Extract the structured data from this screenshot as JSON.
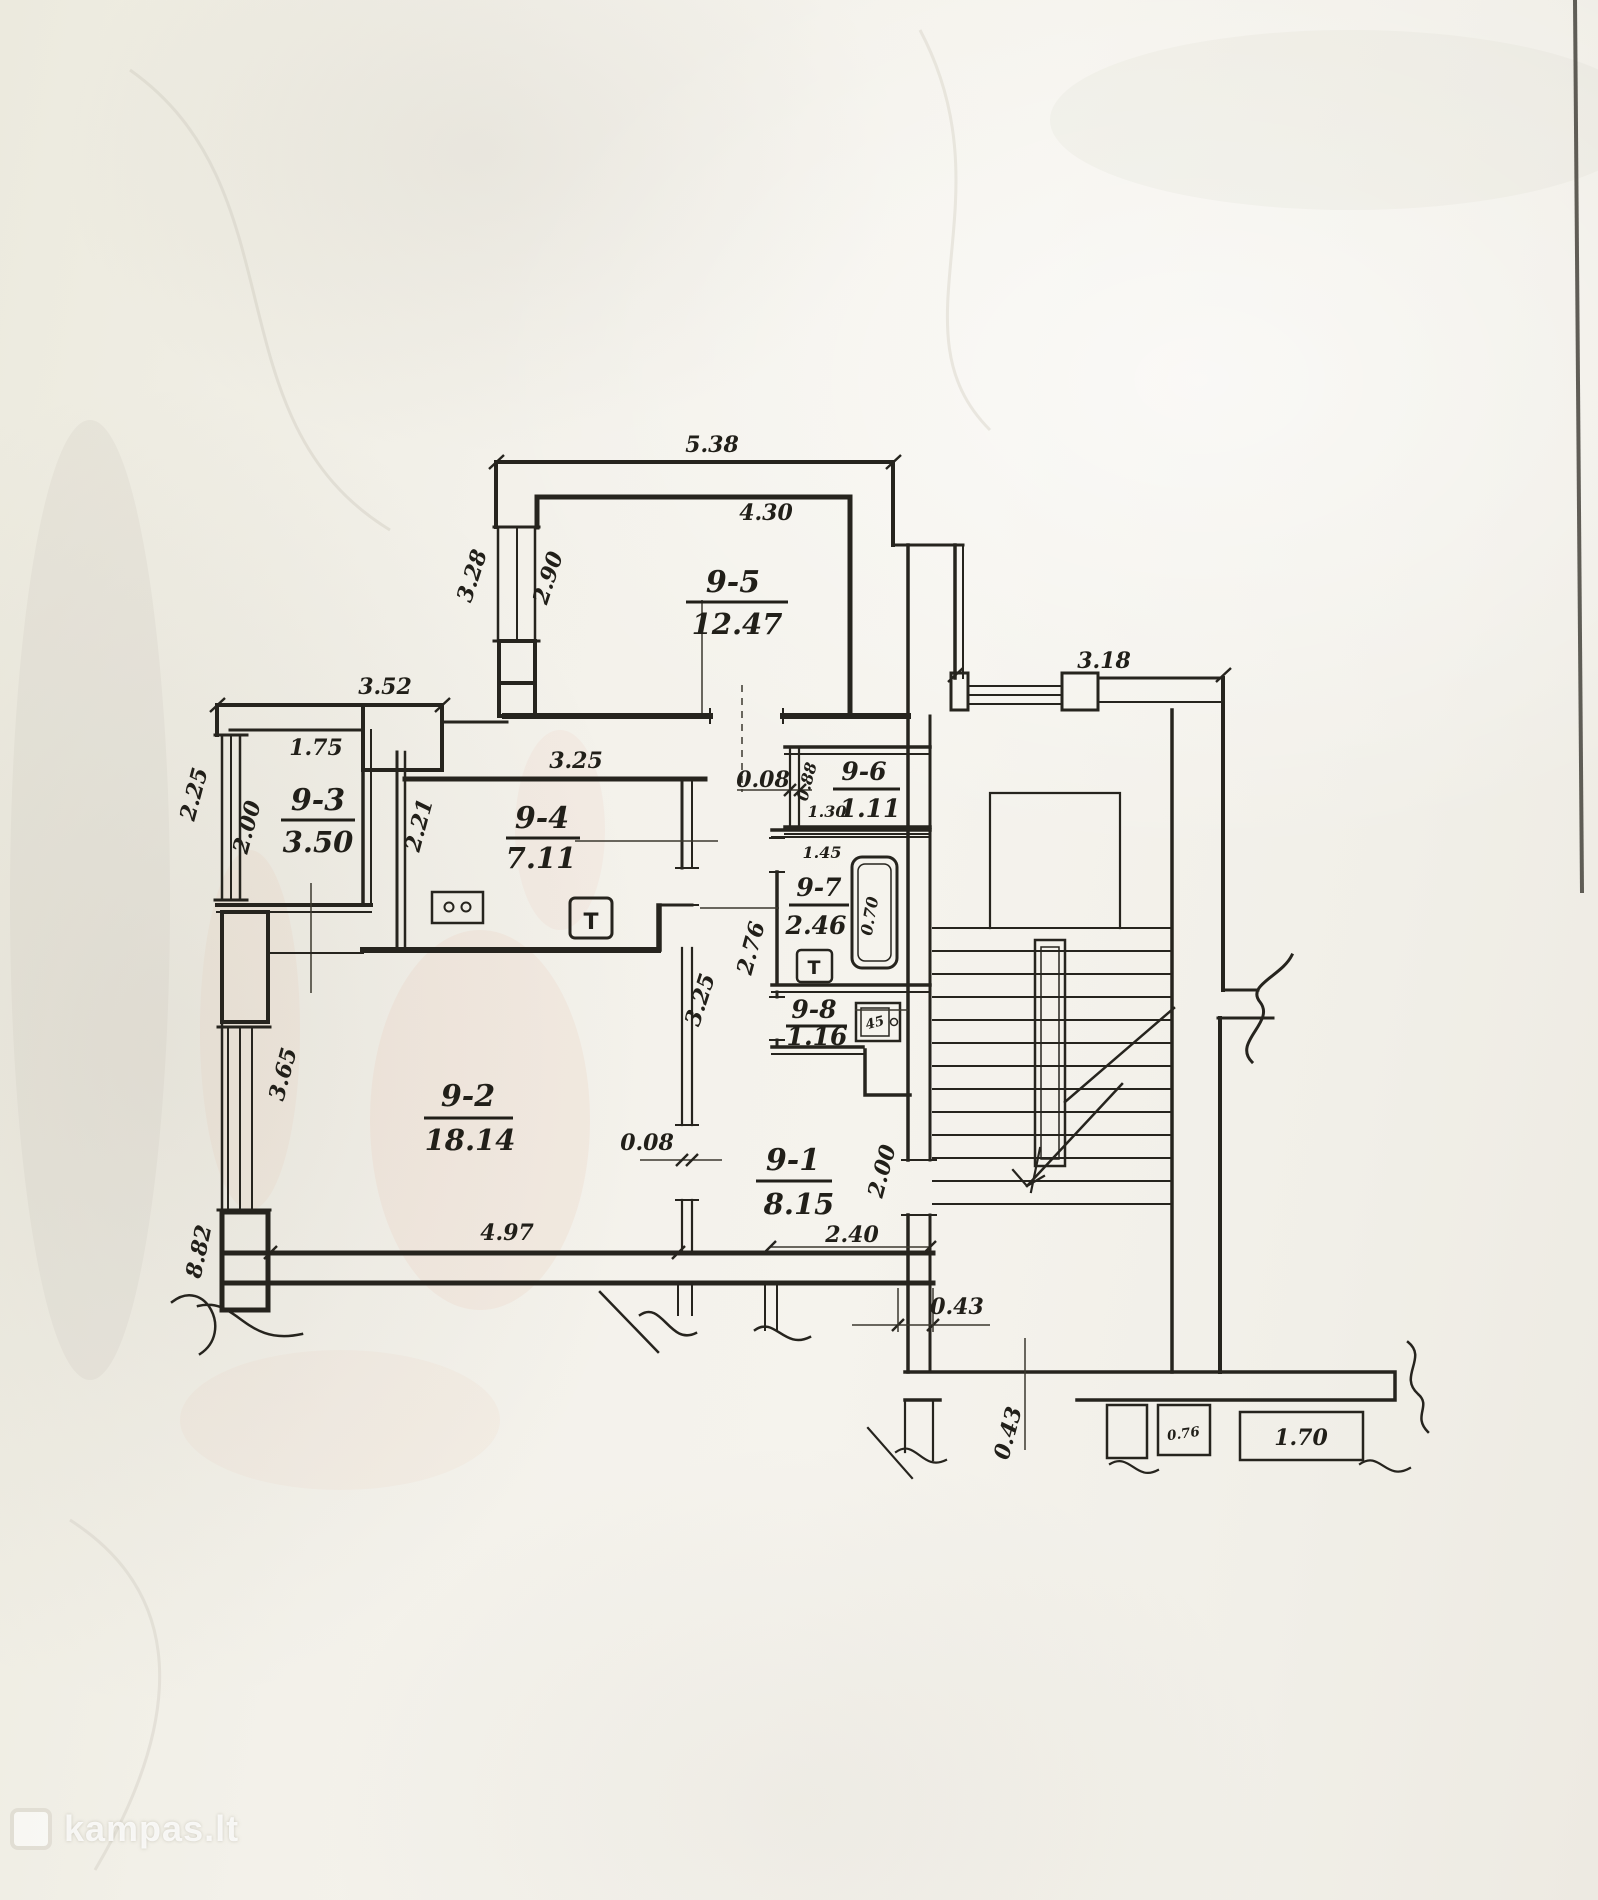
{
  "watermark": {
    "site": "kampas.lt"
  },
  "rooms": [
    {
      "id": "9-5",
      "area": "12.47"
    },
    {
      "id": "9-3",
      "area": "3.50"
    },
    {
      "id": "9-4",
      "area": "7.11"
    },
    {
      "id": "9-6",
      "area": "1.11"
    },
    {
      "id": "9-7",
      "area": "2.46"
    },
    {
      "id": "9-8",
      "area": "1.16"
    },
    {
      "id": "9-2",
      "area": "18.14"
    },
    {
      "id": "9-1",
      "area": "8.15"
    }
  ],
  "dims": {
    "d538": "5.38",
    "d430": "4.30",
    "d328": "3.28",
    "d290": "2.90",
    "d352": "3.52",
    "d175": "1.75",
    "d225": "2.25",
    "d200a": "2.00",
    "d325a": "3.25",
    "d221": "2.21",
    "d008a": "0.08",
    "d088": "0.88",
    "d130": "1.30",
    "d145": "1.45",
    "d276": "2.76",
    "d070": "0.70",
    "d45": "45",
    "d325b": "3.25",
    "d365": "3.65",
    "d882": "8.82",
    "d008b": "0.08",
    "d497": "4.97",
    "d240": "2.40",
    "d200b": "2.00",
    "d318": "3.18",
    "d043a": "0.43",
    "d043b": "0.43",
    "d076": "0.76",
    "d170": "1.70"
  },
  "symbols": {
    "t_kitchen": "T",
    "t_bath": "T"
  }
}
